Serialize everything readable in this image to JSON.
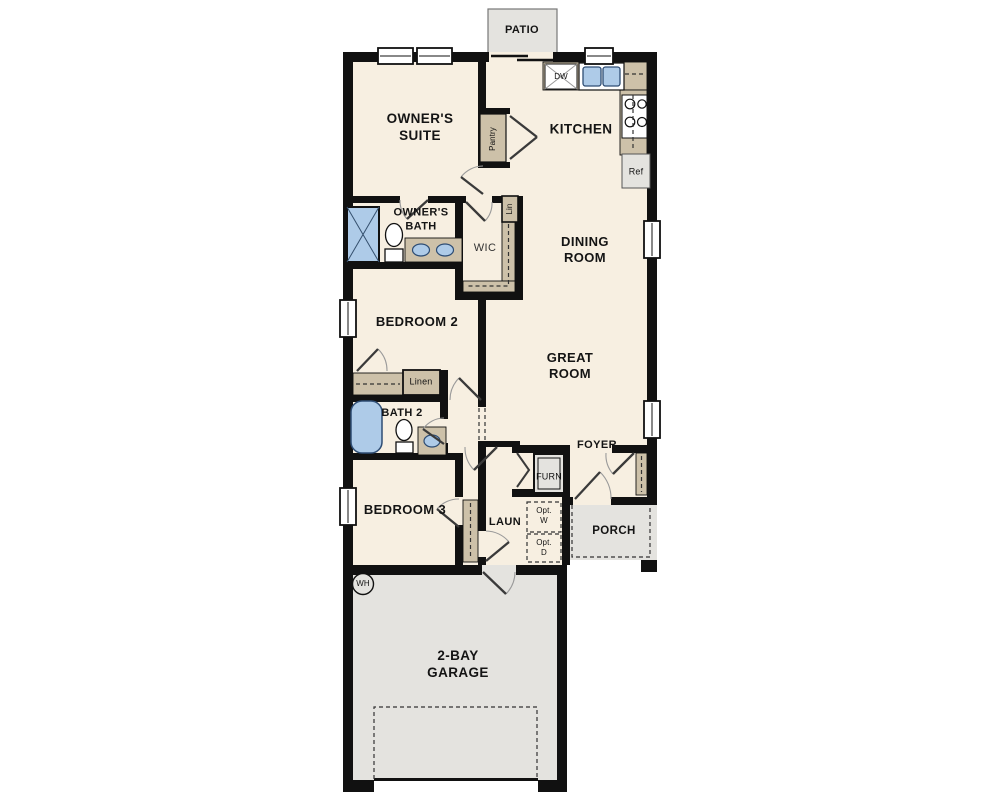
{
  "plan": {
    "type": "single-story residential floor plan",
    "colors": {
      "wall": "#111111",
      "floor": "#f7efe1",
      "concrete": "#e4e3df",
      "casework": "#cdc1a9",
      "fixture_blue": "#aecbe8",
      "fixture_blue_border": "#2e4d74"
    },
    "rooms": {
      "patio": "PATIO",
      "owners_suite": "OWNER'S\nSUITE",
      "kitchen": "KITCHEN",
      "owners_bath": "OWNER'S\nBATH",
      "wic": "WIC",
      "dining": "DINING\nROOM",
      "bedroom2": "BEDROOM 2",
      "bath2": "BATH 2",
      "great_room": "GREAT\nROOM",
      "foyer": "FOYER",
      "bedroom3": "BEDROOM 3",
      "laundry": "LAUN",
      "porch": "PORCH",
      "garage": "2-BAY\nGARAGE"
    },
    "fixtures": {
      "dishwasher": "DW",
      "refrigerator": "Ref",
      "pantry": "Pantry",
      "linen_wic": "Lin",
      "linen_hall": "Linen",
      "furnace": "FURN",
      "water_heater": "WH",
      "opt_washer": "Opt.\nW",
      "opt_dryer": "Opt.\nD"
    }
  }
}
